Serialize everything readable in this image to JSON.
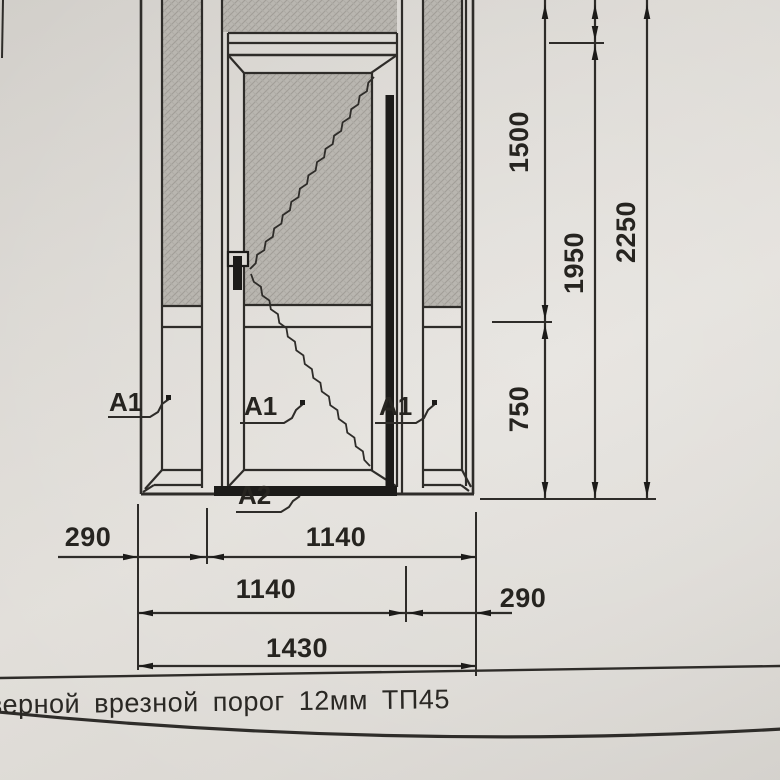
{
  "colors": {
    "paper": "#dcd9d4",
    "line": "#2e2c29",
    "glass_fill": "#b9b6b0",
    "solid_black": "#1c1b19"
  },
  "elevation": {
    "description_labels": {
      "callouts": [
        {
          "label": "А1"
        },
        {
          "label": "А1"
        },
        {
          "label": "А1"
        },
        {
          "label": "А2"
        }
      ]
    },
    "vertical_dims": [
      {
        "value": "1500"
      },
      {
        "value": "750"
      },
      {
        "value": "1950"
      },
      {
        "value": "2250"
      }
    ],
    "horizontal_dims": [
      {
        "value": "290"
      },
      {
        "value": "1140"
      },
      {
        "value": "1140"
      },
      {
        "value": "290"
      },
      {
        "value": "1430"
      }
    ]
  },
  "title_row": {
    "text": "верной врезной порог 12мм ТП45"
  }
}
